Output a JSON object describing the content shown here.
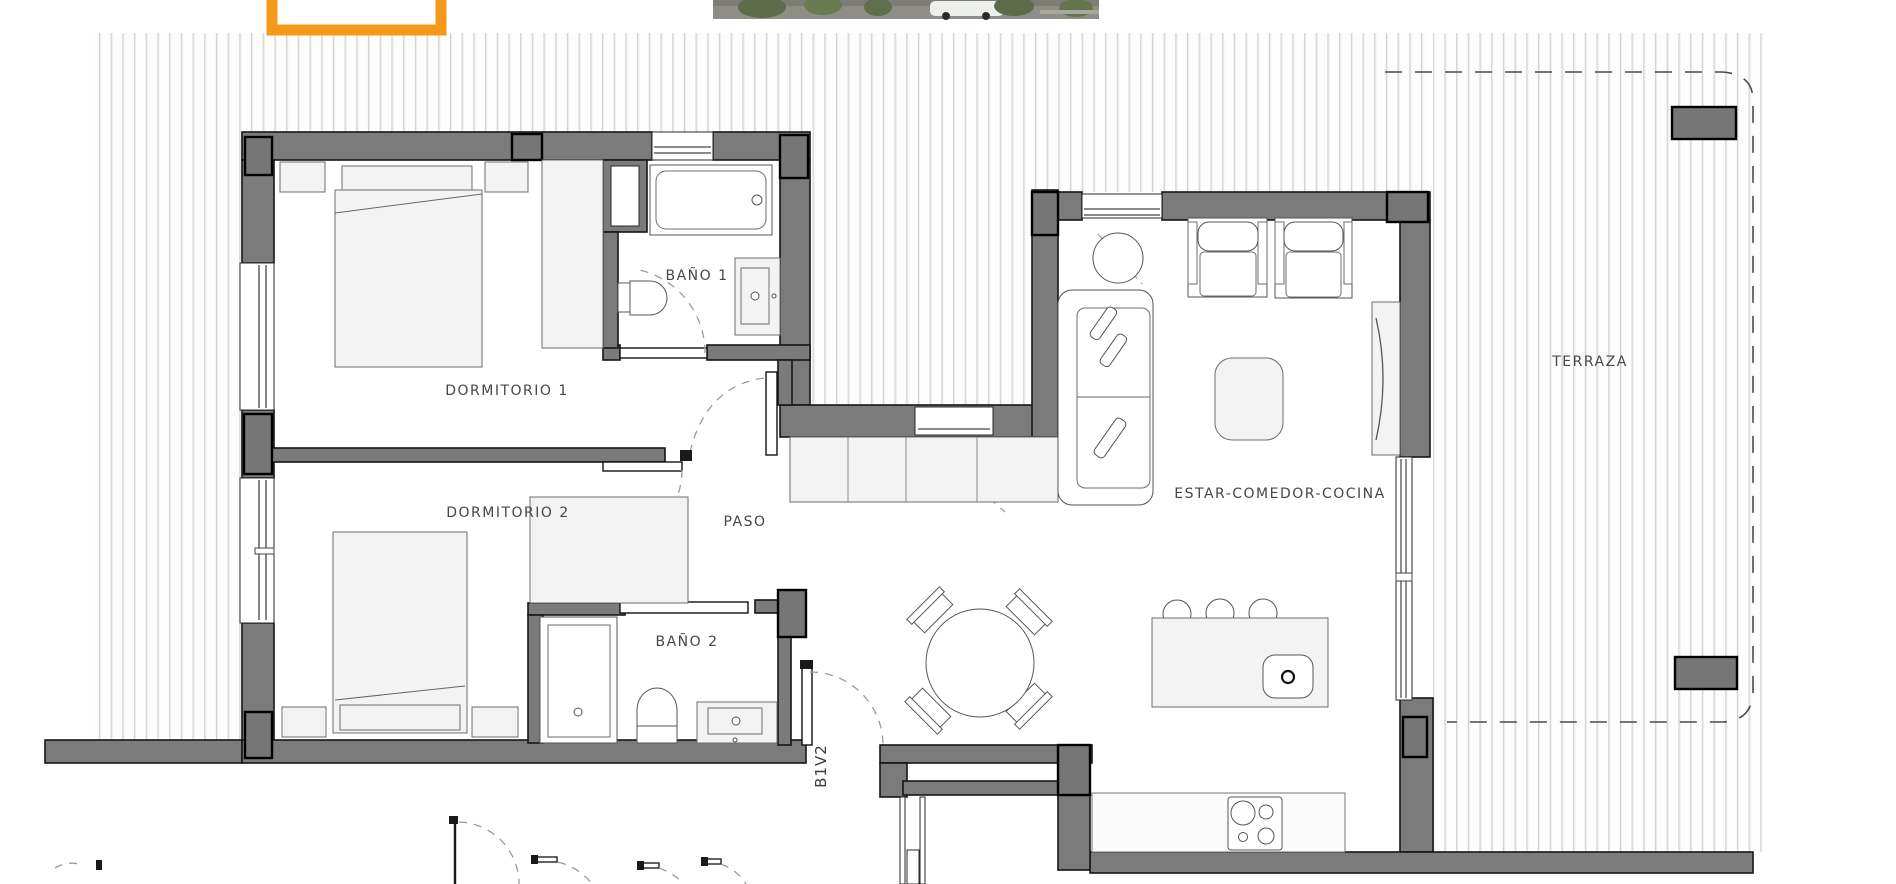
{
  "gallery": {
    "selected_thumbnail_color": "#F4991A",
    "photo_strip_alt": "exterior-street-render-cropped"
  },
  "floorplan": {
    "unit_code": "B1V2",
    "rooms": [
      {
        "id": "dormitorio-1",
        "label": "DORMITORIO 1"
      },
      {
        "id": "bano-1",
        "label": "BAÑO 1"
      },
      {
        "id": "dormitorio-2",
        "label": "DORMITORIO 2"
      },
      {
        "id": "paso",
        "label": "PASO"
      },
      {
        "id": "bano-2",
        "label": "BAÑO 2"
      },
      {
        "id": "estar-comedor-cocina",
        "label": "ESTAR-COMEDOR-COCINA"
      },
      {
        "id": "terraza",
        "label": "TERRAZA"
      }
    ],
    "colors": {
      "wall": "#7b7b7b",
      "hatch_line": "#cfcfcf",
      "accent_orange": "#F4991A",
      "dashed_boundary": "#4a4a4a"
    }
  }
}
